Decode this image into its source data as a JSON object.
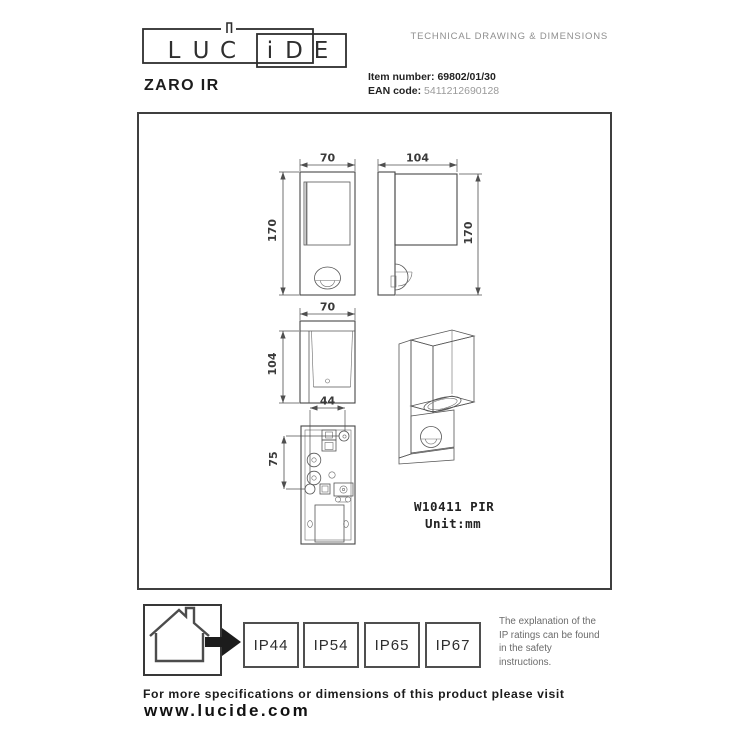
{
  "header": {
    "logo": {
      "letters": [
        "L",
        "U",
        "C",
        "i",
        "D",
        "E"
      ]
    },
    "doc_type": "TECHNICAL DRAWING & DIMENSIONS",
    "product_name": "ZARO IR",
    "item_number_label": "Item number:",
    "item_number": "69802/01/30",
    "ean_label": "EAN code:",
    "ean": "5411212690128"
  },
  "drawing": {
    "dims": {
      "front_width": "70",
      "front_height": "170",
      "side_depth": "104",
      "side_height": "170",
      "top_width": "70",
      "top_depth": "104",
      "plate_hole_spacing_x": "44",
      "plate_hole_spacing_y": "75"
    },
    "model_code": "W10411 PIR",
    "unit_label": "Unit:mm"
  },
  "ip_section": {
    "ratings": [
      "IP44",
      "IP54",
      "IP65",
      "IP67"
    ],
    "explanation": "The explanation of the\nIP ratings can be found\nin the safety\ninstructions."
  },
  "footer": {
    "line1": "For more specifications or dimensions of this product please visit",
    "website": "www.lucide.com"
  },
  "colors": {
    "ink": "#1d1d1d",
    "line": "#4f4f4f",
    "muted": "#8f8f8f"
  }
}
